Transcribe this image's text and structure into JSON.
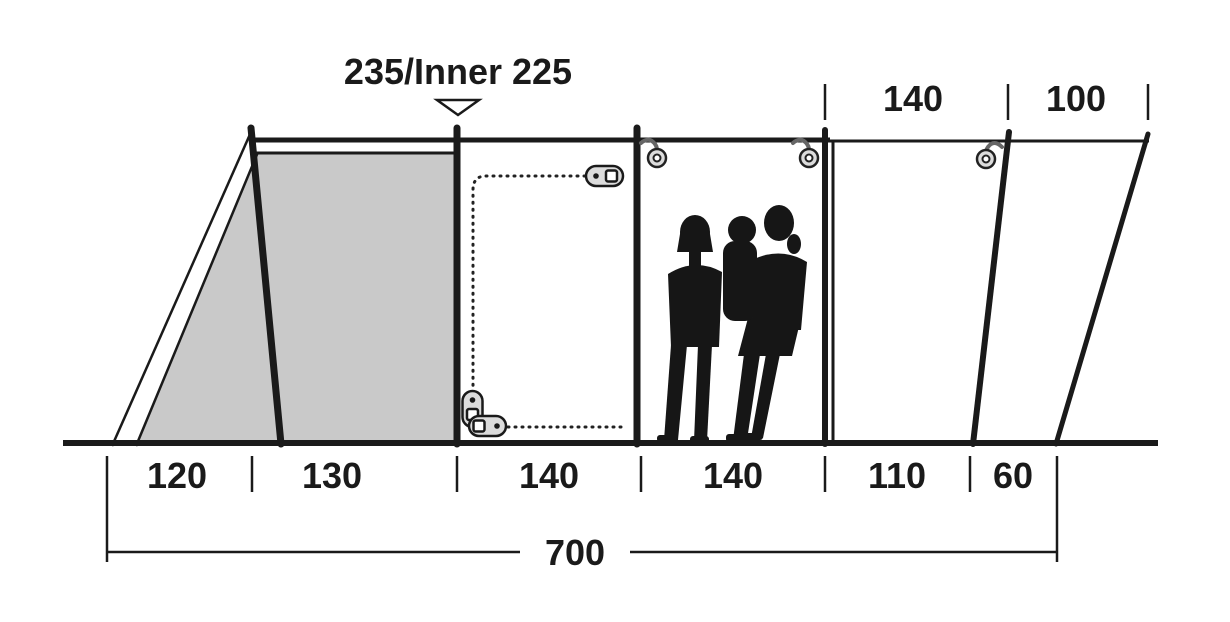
{
  "diagram": {
    "type": "tent-side-profile-dimension-diagram",
    "title": "235/Inner 225",
    "top_dims": [
      "140",
      "100"
    ],
    "bottom_dims": [
      "120",
      "130",
      "140",
      "140",
      "110",
      "60"
    ],
    "total_length": "700"
  },
  "icons": {
    "height_arrow": "down-triangle-icon",
    "zip_puller": "zip-puller-icon",
    "hanger_ring": "ring-hook-icon",
    "door_zip": "dotted-zip-line",
    "family": "family-silhouette"
  },
  "colors": {
    "line": "#1a1a1a",
    "inner_tent_fill": "#c9c9c9",
    "hardware_fill": "#dcdcdc",
    "silhouette": "#161616",
    "background": "#ffffff"
  }
}
